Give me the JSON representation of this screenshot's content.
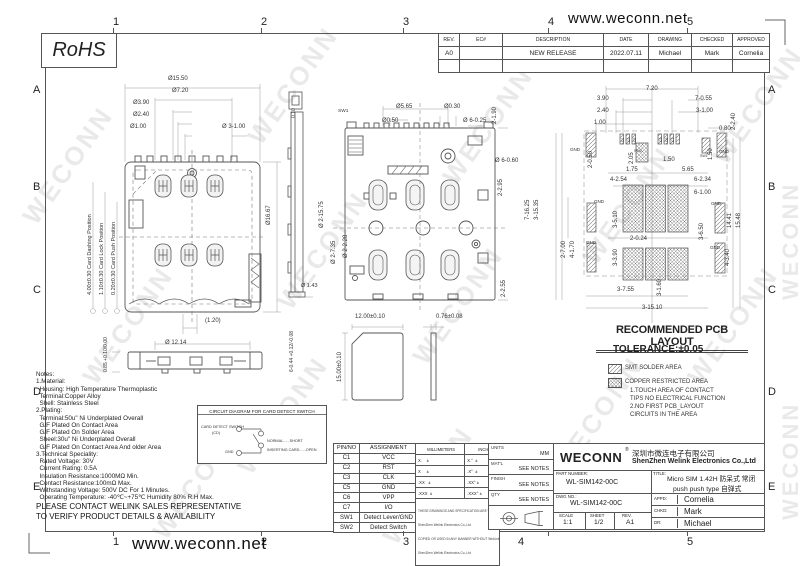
{
  "header": {
    "url": "www.weconn.net"
  },
  "footer": {
    "url": "www.weconn.net"
  },
  "grid": {
    "cols": [
      "1",
      "2",
      "3",
      "4",
      "5"
    ],
    "rows": [
      "A",
      "B",
      "C",
      "D",
      "E"
    ]
  },
  "watermark": {
    "text": "WECONN"
  },
  "rohs": {
    "label": "RoHS"
  },
  "revision_table": {
    "headers": [
      "REV.",
      "EC#",
      "DESCRIPTION",
      "DATE",
      "DRAWING",
      "CHECKED",
      "APPROVED"
    ],
    "rows": [
      [
        "A0",
        "",
        "NEW RELEASE",
        "2022.07.11",
        "Michael",
        "Mark",
        "Cornelia"
      ],
      [
        "",
        "",
        "",
        "",
        "",
        "",
        ""
      ]
    ]
  },
  "left_view": {
    "dim_overall_width": "Ø15.50",
    "dim_7_20": "Ø7.20",
    "dim_3_90": "Ø3.90",
    "dim_2_40": "Ø2.40",
    "dim_1_00": "Ø1.00",
    "dim_3x1_00": "Ø 3-1.00",
    "dim_height": "Ø16.67",
    "dim_1_20": "(1.20)",
    "card_dashing": "4.00±0.30 Card Dashing Position",
    "card_lock": "1.10±0.30 Card Lock Position",
    "card_push": "0.20±0.30 Card Push Position"
  },
  "side_view": {
    "dim_width": "Ø 12.14",
    "dim_height": "0.85 +0.10/0.00",
    "dim_pins": "6-0.44 +0.12/-0.08"
  },
  "edge_view": {
    "dim_flat": "0.10",
    "dim_1_43": "Ø 1.43"
  },
  "middle_view": {
    "sw1": "SW1",
    "dim_5_65": "Ø5.65",
    "dim_0_50": "Ø0.50",
    "dim_0_30": "Ø0.30",
    "dim_6x0_25": "Ø 6-0.25",
    "dim_2x1_90": "2-1.90",
    "dim_6x0_60": "Ø 6-0.60",
    "dim_2x2_95": "2-2.95",
    "dim_2x2_55": "2-2.55",
    "dim_2x15_75": "Ø 2-15.75",
    "dim_2x7_35": "Ø 2-7.35",
    "dim_2x2_28": "Ø 2-2.28"
  },
  "card_view": {
    "dim_w": "12.00±0.10",
    "dim_h": "15.00±0.10",
    "dim_t": "0.76±0.08"
  },
  "pcb_view": {
    "dims_top": {
      "d7_20": "7.20",
      "d3_90": "3.90",
      "d2_40": "2.40",
      "d1_00": "1.00",
      "d7x0_55": "7-0.55",
      "d3x1_00": "3-1.00",
      "d2x2_40": "2-2.40",
      "d0_80": "0.80"
    },
    "dims_upper": {
      "d2_05": "2.05",
      "d1_75": "1.75",
      "d1_50a": "1.50",
      "d5_65": "5.65",
      "d2x0_50": "2-0.50",
      "d1_50b": "1.50"
    },
    "dims_mid": {
      "d4x2_54": "4-2.54",
      "d6x2_34": "6-2.34",
      "d6x1_00": "6-1.00",
      "d3x5_10": "3-5.10",
      "d3x6_50": "3-6.50",
      "d2x0_24": "2-0.24",
      "d3x3_90": "3-3.90",
      "d3x1_60": "3-1.60"
    },
    "dims_left": {
      "d7x16_25": "7-16.25",
      "d3x15_35": "3-15.35",
      "d2x7_00": "2-7.00",
      "d4x1_70": "4-1.70"
    },
    "dims_right": {
      "d14_41": "14.41",
      "d15_48": "15.48",
      "d4x3_40": "4-3.40"
    },
    "dims_bottom": {
      "d3x7_55": "3-7.55",
      "d3x15_10": "3-15.10"
    },
    "gnd": "GND",
    "sw1": "SW1",
    "sw2": "SW2",
    "pad_labels": [
      "C1",
      "C2",
      "C3",
      "C5",
      "C6",
      "C7"
    ]
  },
  "pcb_info": {
    "title": "RECOMMENDED PCB LAYOUT",
    "tolerance": "TOLERANCE:±0.05",
    "smt_label": "SMT SOLDER AREA",
    "copper_label": "COPPER RESTRICTED AREA",
    "copper_note1": "1.TOUCH AREA OF CONTACT",
    "copper_note2": "TIPS NO ELECTRICAL FUNCTION",
    "copper_note3": "2.NO FIRST PCB_LAYOUT",
    "copper_note4": "CIRCUITS IN THE AREA"
  },
  "notes": {
    "lines": [
      "Notes:",
      "1.Material:",
      "  Housing: High Temperature Thermoplastic",
      "  Terminal:Copper Alloy",
      "  Shell: Stainless Steel",
      "2.Plating:",
      "  Terminal:50u\" Ni Underplated Overall",
      "  G/F Plated On Contact Area",
      "  G/F Plated On Solder Area",
      "  Sheel:30u\" Ni Underplated Overall",
      "  G/F Plated On Contact Area And older Area",
      "3.Technical Speciality:",
      "  Rated Voltage: 30V",
      "  Current Rating: 0.5A",
      "  Insulation Resistance:1000MΩ Min.",
      "  Contact Resistance:100mΩ Max.",
      "  Withstanding Voltage: 500V DC For 1 Minutes.",
      "  Operating Temperature: -40℃~+75℃ Humidity 80% R.H Max."
    ],
    "contact1": "PLEASE CONTACT WELINK SALES REPRESENTATIVE",
    "contact2": "TO VERIFY PRODUCT DETAILS & AVAILABILITY"
  },
  "circuit": {
    "title": "CIRCUIT DIAGRAM FOR CARD DETECT SWITCH",
    "switch_label": "CARD DETECT SWITCH",
    "cd": "(CD)",
    "gnd": "GND",
    "normal": "NORMAL......SHORT",
    "inserting": "INSERTING CARD......OPEN"
  },
  "pin_table": {
    "headers": [
      "PIN/NO",
      "ASSIGNMENT"
    ],
    "rows": [
      [
        "C1",
        "VCC"
      ],
      [
        "C2",
        "RST"
      ],
      [
        "C3",
        "CLK"
      ],
      [
        "C5",
        "GND"
      ],
      [
        "C6",
        "VPP"
      ],
      [
        "C7",
        "I/O"
      ],
      [
        "SW1",
        "Detect Lever/GND"
      ],
      [
        "SW2",
        "Detect Switch"
      ]
    ]
  },
  "tol_table": {
    "mm": "MILLIMETERS",
    "inch": "INCH",
    "rows_mm": [
      "X.    ±",
      "X     ±",
      ".XX   ±",
      ".XXX  ±"
    ],
    "rows_inch": [
      "X.°  ±",
      ".X°  ±",
      ".XX° ±",
      ".XXX° ±"
    ],
    "disclaimer": [
      "THESE DRAWINGS AND SPECIFICATION ARE WeiLink",
      "ShenZhen Welink Electronics Co.,Ltd",
      "COPIED OR USED IN ANY MANNER WITHOUT WeiLink",
      "ShenZhen Welink Electronics Co.,Ltd"
    ]
  },
  "info_col": {
    "units_label": "UNITS",
    "units": "MM",
    "matl_label": "MAT'L",
    "matl": "SEE NOTES",
    "finish_label": "FINISH",
    "finish": "SEE NOTES",
    "qty_label": "QTY",
    "qty": "SEE NOTES"
  },
  "title_block": {
    "brand": "WECONN",
    "reg": "®",
    "company_cn": "深圳市微连电子有限公司",
    "company_en": "ShenZhen Welink Electronics Co.,Ltd",
    "part_number_label": "PART NUMBER:",
    "part_number": "WL-SIM142-00C",
    "title_label": "TITLE:",
    "title_line1": "Micro SIM 1.42H 防呆式 常闭",
    "title_line2": "push push type 自弹式",
    "dwg_label": "DWG NO.:",
    "dwg_no": "WL-SIM142-00C",
    "scale_label": "SCALE",
    "scale": "1:1",
    "sheet_label": "SHEET",
    "sheet": "1/2",
    "rev_label": "REV.",
    "rev": "A1",
    "appd_label": "APPD:",
    "appd": "Cornelia",
    "chkd_label": "CHKD:",
    "chkd": "Mark",
    "dr_label": "DR:",
    "dr": "Michael"
  }
}
